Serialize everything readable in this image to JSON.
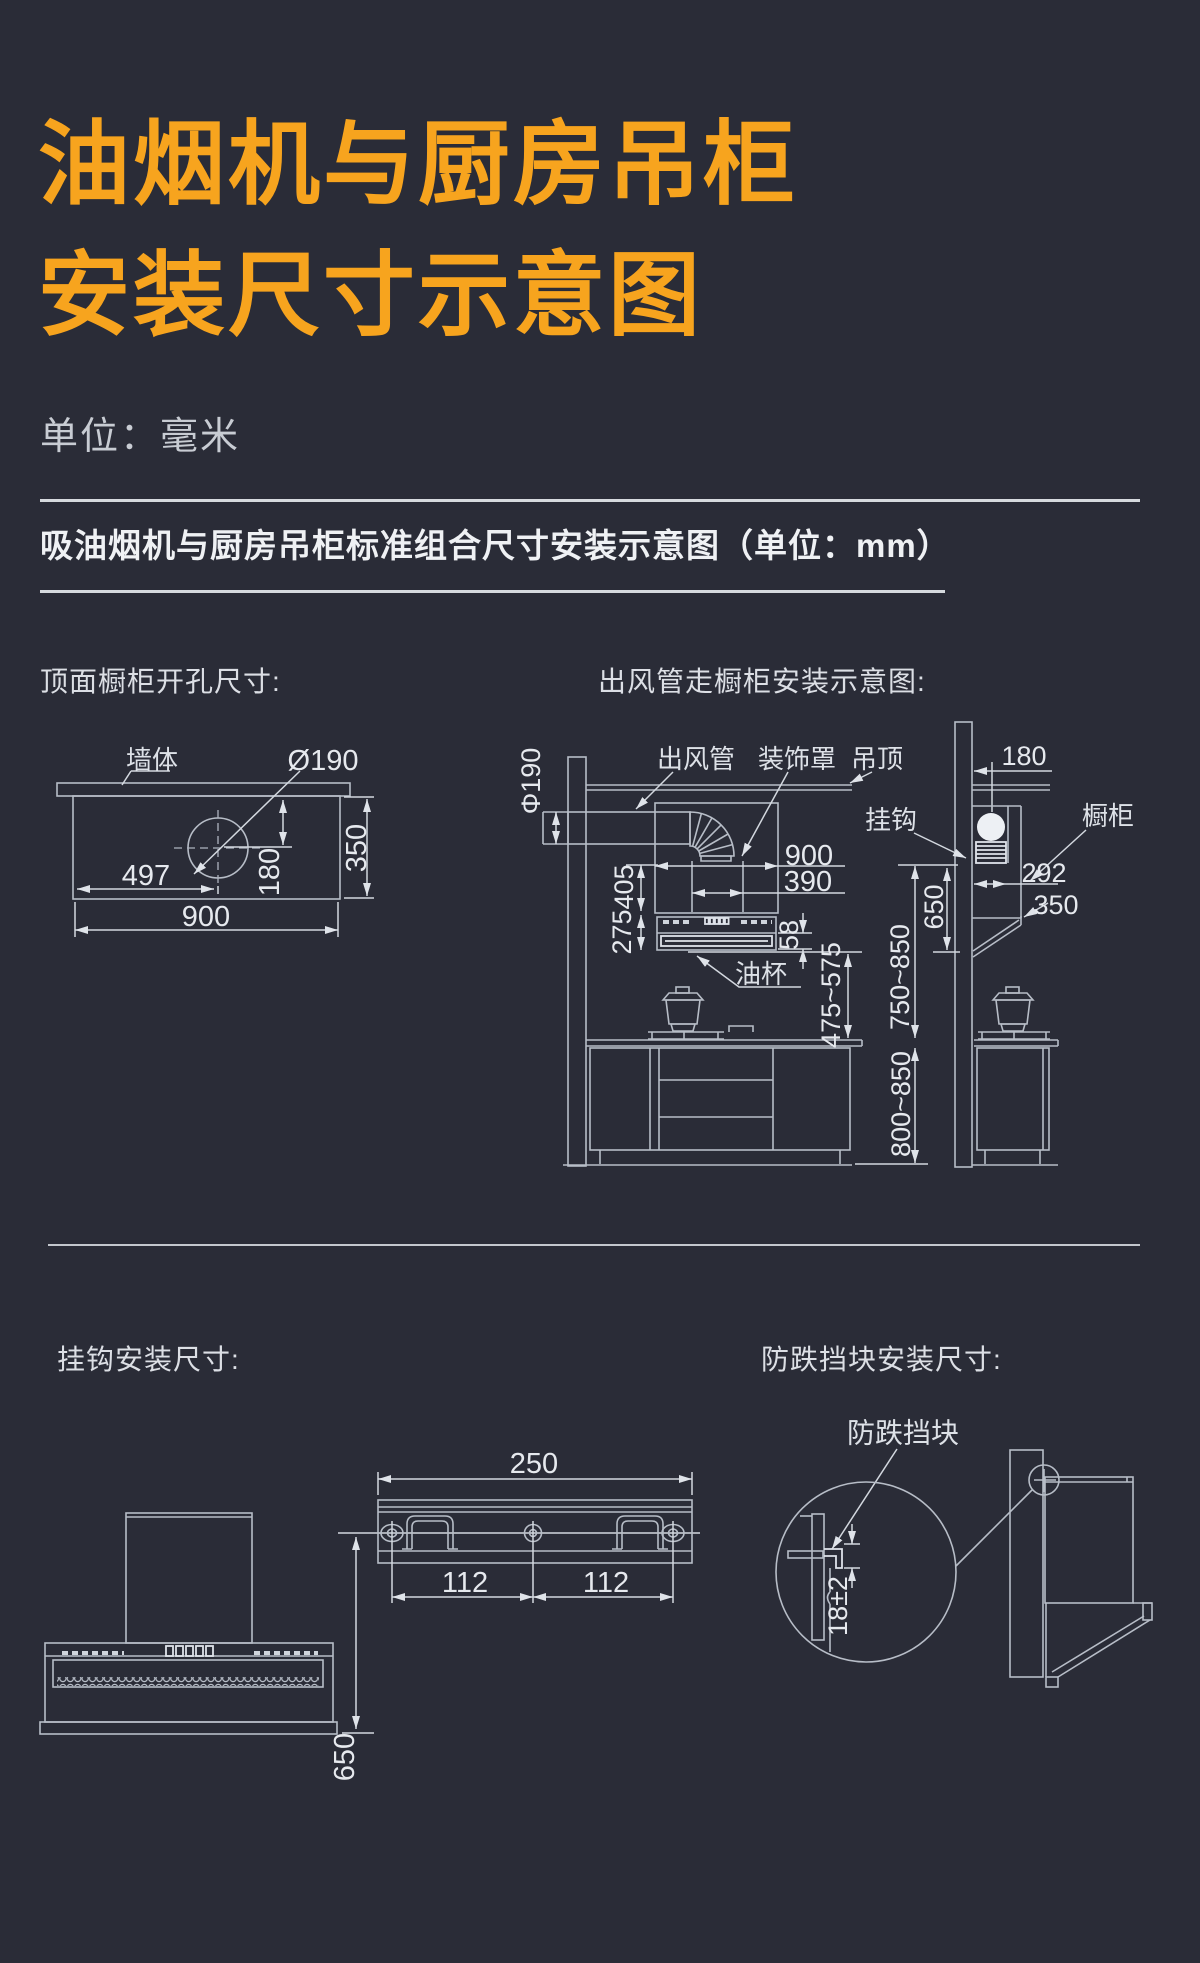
{
  "colors": {
    "background": "#2a2c37",
    "accent": "#f7a41e",
    "line": "#b7bdc7",
    "text": "#e6e9ee"
  },
  "title": {
    "line1": "油烟机与厨房吊柜",
    "line2": "安装尺寸示意图"
  },
  "unit_note": "单位：毫米",
  "section_header": "吸油烟机与厨房吊柜标准组合尺寸安装示意图（单位：mm）",
  "top_left": {
    "title": "顶面橱柜开孔尺寸:",
    "wall_label": "墙体",
    "hole_label": "Ø190",
    "dim_offset_x": "497",
    "dim_offset_y": "180",
    "dim_depth": "350",
    "dim_width": "900"
  },
  "top_right": {
    "title": "出风管走橱柜安装示意图:",
    "duct_label": "出风管",
    "cover_label": "装饰罩",
    "ceiling_label": "吊顶",
    "hook_label": "挂钩",
    "cabinet_label": "橱柜",
    "oil_cup_label": "油杯",
    "duct_dia": "Φ190",
    "cabinet_width": "900",
    "cover_width": "390",
    "dim_405": "405",
    "dim_275": "275",
    "dim_58": "58",
    "hood_clearance": "475~575",
    "hook_height": "750~850",
    "counter_height": "800~850",
    "dim_650": "650",
    "wall_offset": "180",
    "dim_292": "292",
    "dim_350": "350"
  },
  "bottom_left": {
    "title": "挂钩安装尺寸:",
    "bar_width": "250",
    "span_left": "112",
    "span_right": "112",
    "dim_650": "650"
  },
  "bottom_right": {
    "title": "防跌挡块安装尺寸:",
    "block_label": "防跌挡块",
    "clearance": "18±2"
  }
}
